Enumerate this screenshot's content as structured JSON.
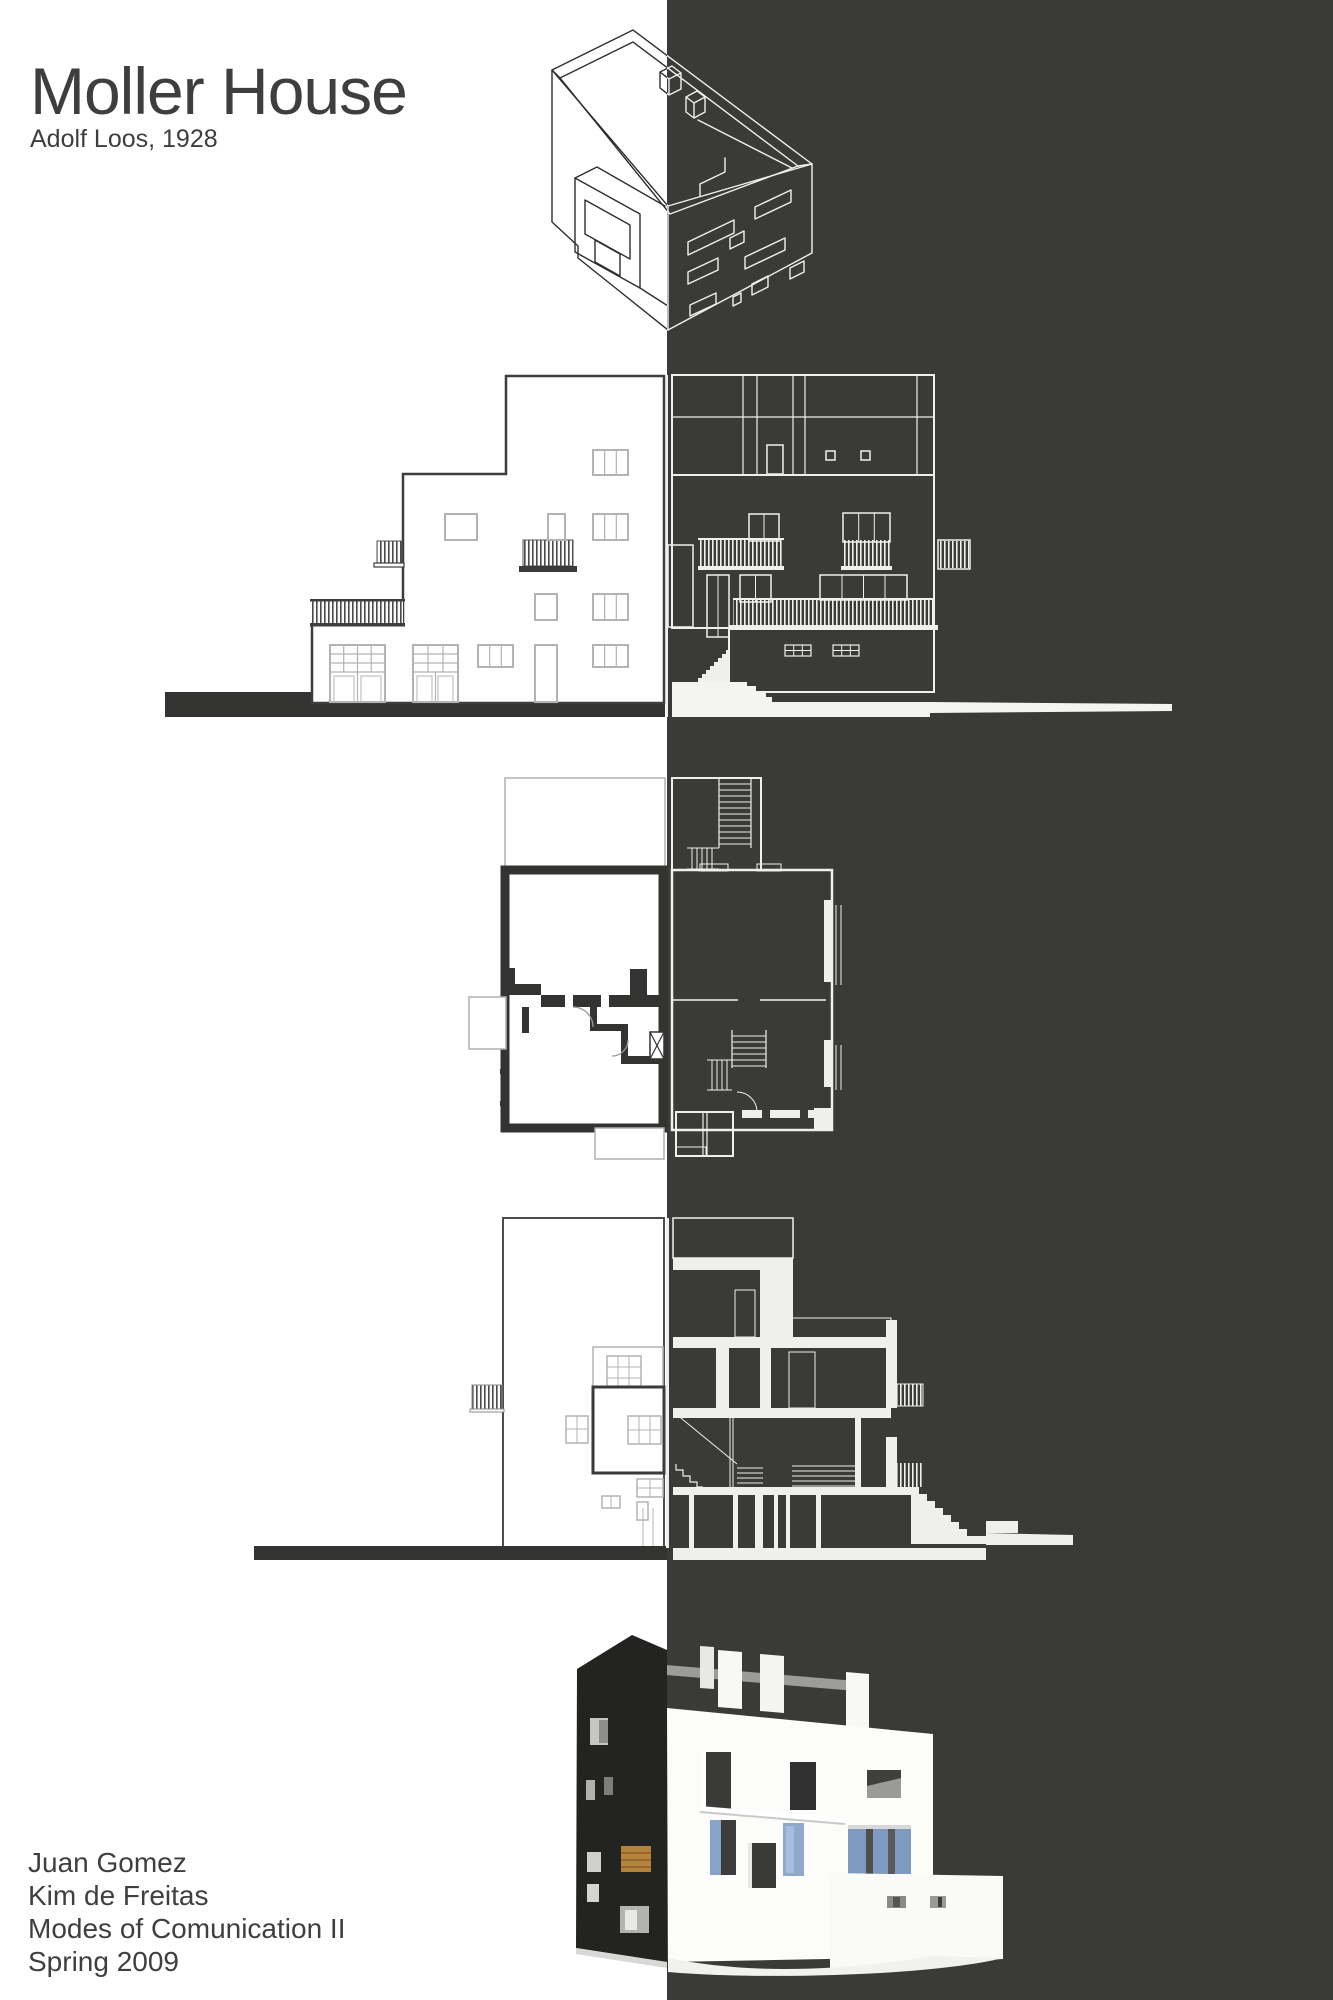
{
  "header": {
    "title": "Moller House",
    "subtitle": "Adolf Loos, 1928"
  },
  "credits": {
    "lines": [
      "Juan Gomez",
      "Kim de Freitas",
      "Modes of Comunication II",
      "Spring 2009"
    ]
  },
  "palette": {
    "background_left": "#ffffff",
    "background_right": "#3a3a38",
    "ink_dark": "#3e3e3e",
    "poche_black": "#333331",
    "line_light_gray": "#b3b3b1",
    "line_white": "#efefed",
    "render_window_orange": "#b5823c",
    "render_glass_blue": "#7e9ac2"
  },
  "figures": [
    {
      "name": "axonometric"
    },
    {
      "name": "elevation"
    },
    {
      "name": "floor-plan"
    },
    {
      "name": "section"
    },
    {
      "name": "model-render"
    }
  ]
}
